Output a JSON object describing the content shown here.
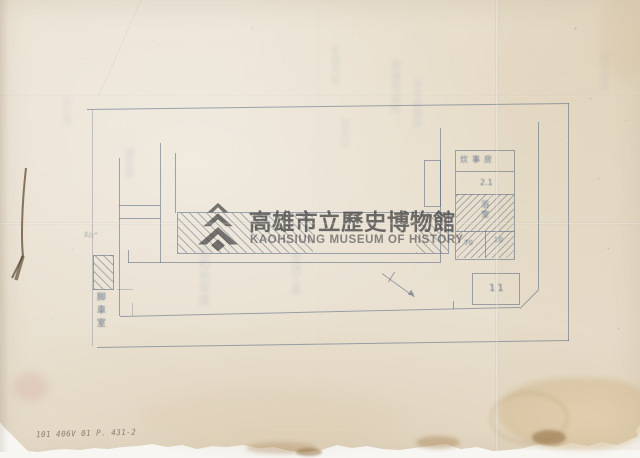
{
  "watermark": {
    "title_zh": "高雄市立歷史博物館",
    "title_en": "KAOHSIUNG MUSEUM OF HISTORY"
  },
  "plan": {
    "room_table": {
      "row1_label": "炊事房",
      "row2_label": "2.1",
      "row3_label": "浴室",
      "row4_left": "70",
      "row4_right": "10"
    },
    "garage_label": "11",
    "bicycle_room_label": "脚車室",
    "left_scribble": "2△∽"
  },
  "annotations": {
    "pencil_note": "101 406V 01 P. 431-2"
  },
  "bleedthrough": {
    "col1": "年度市有",
    "col2": "高雄市役所",
    "col3": "保存書類綴",
    "col4": "昭和拾年度",
    "col5": "營繕工事",
    "col6": "圖面綴",
    "col7": "建物臺帳",
    "col8": "設計書",
    "col9": "變更屆"
  },
  "colors": {
    "paper": "#ebe3d4",
    "plan_ink": "#586880",
    "watermark_gray": "#464646",
    "stain_tan": "#cdb28a"
  }
}
